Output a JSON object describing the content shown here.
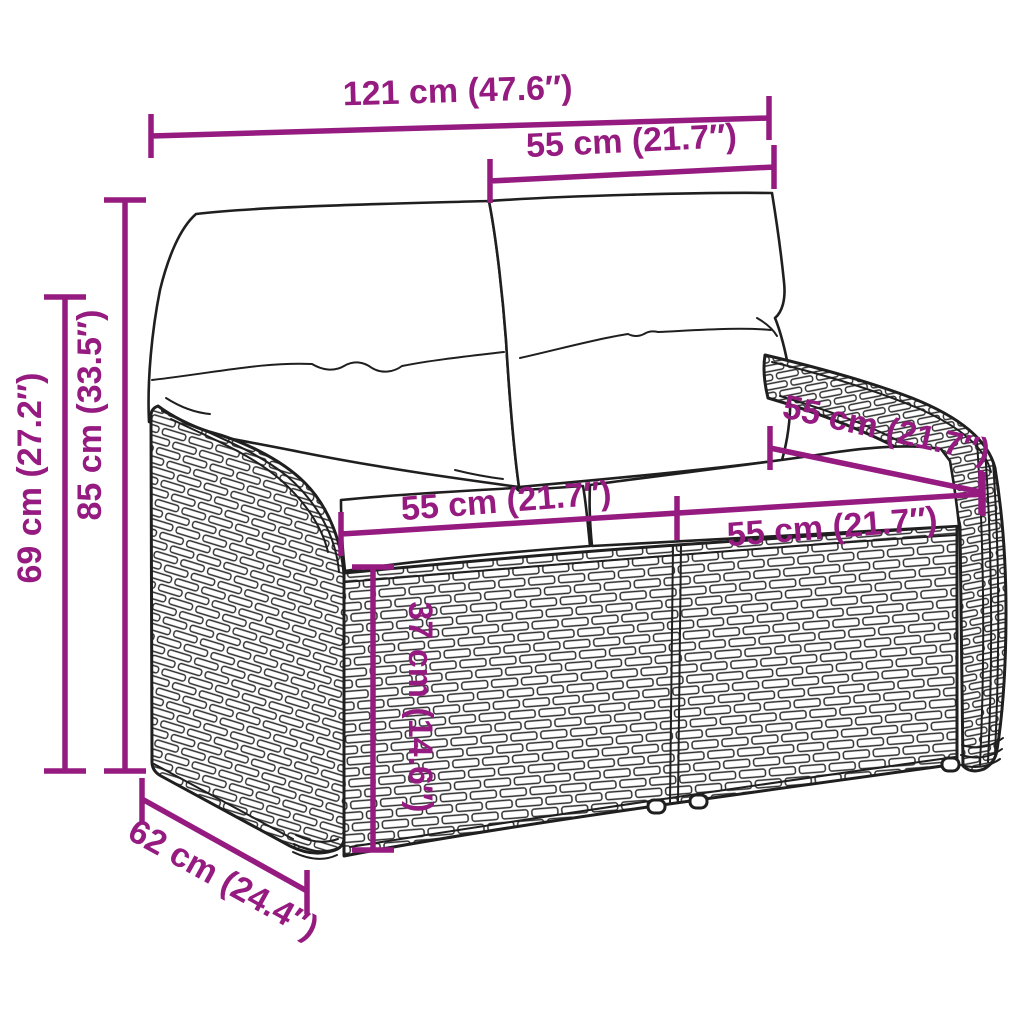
{
  "diagram": {
    "subject": "rattan-garden-bench-with-cushions",
    "units": "cm-and-inches"
  },
  "colors": {
    "dimension_accent": "#951B81",
    "line_art": "#1F1F1F",
    "cushion": "#FFFFFF",
    "background": "#FFFFFF"
  },
  "annotations": [
    {
      "id": "overall-width",
      "label": "121 cm (47.6″)"
    },
    {
      "id": "backrest-width",
      "label": "55 cm (21.7″)"
    },
    {
      "id": "total-height",
      "label": "85 cm (33.5″)"
    },
    {
      "id": "arm-height",
      "label": "69 cm (27.2″)"
    },
    {
      "id": "seat-width-left",
      "label": "55 cm (21.7″)"
    },
    {
      "id": "seat-width-right",
      "label": "55 cm (21.7″)"
    },
    {
      "id": "seat-depth",
      "label": "55 cm (21.7″)"
    },
    {
      "id": "seat-height",
      "label": "37 cm (14.6″)"
    },
    {
      "id": "overall-depth",
      "label": "62 cm (24.4″)"
    }
  ]
}
